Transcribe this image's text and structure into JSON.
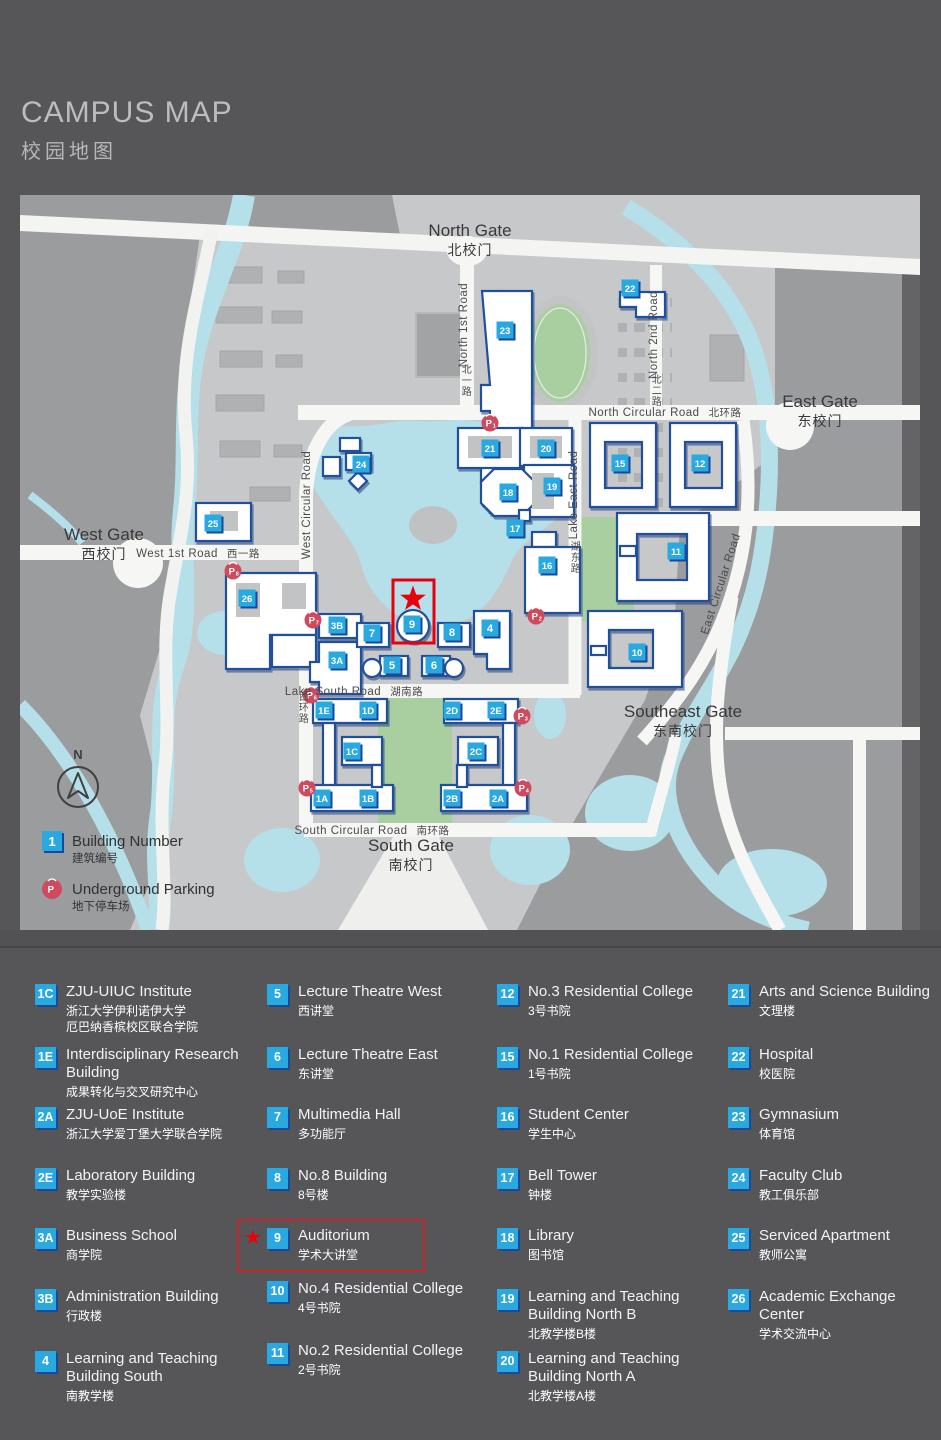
{
  "title": {
    "en": "CAMPUS MAP",
    "zh": "校园地图"
  },
  "colors": {
    "accent_blue": "#29a9e0",
    "badge_shadow": "#194b9d",
    "building_outline": "#24509b",
    "highlight_red": "#e8000d",
    "legend_box_red": "#c2262e",
    "parking_red": "#ce4a5e",
    "water": "#b5dfe9",
    "green": "#a9cfa0",
    "map_bg": "#c7c8c9",
    "outside_gray": "#9b9c9e"
  },
  "map": {
    "gates": [
      {
        "id": "north-gate",
        "en": "North Gate",
        "zh": "北校门",
        "x": 450,
        "y": 41
      },
      {
        "id": "east-gate",
        "en": "East Gate",
        "zh": "东校门",
        "x": 800,
        "y": 212
      },
      {
        "id": "west-gate",
        "en": "West Gate",
        "zh": "西校门",
        "x": 84,
        "y": 345
      },
      {
        "id": "southeast-gate",
        "en": "Southeast Gate",
        "zh": "东南校门",
        "x": 663,
        "y": 522
      },
      {
        "id": "south-gate",
        "en": "South Gate",
        "zh": "南校门",
        "x": 391,
        "y": 656
      }
    ],
    "road_labels": [
      {
        "id": "north-circular-road",
        "en": "North Circular Road",
        "zh": "北环路",
        "x": 645,
        "y": 221,
        "rot": 0
      },
      {
        "id": "north-1st-road",
        "en": "North 1st Road",
        "x": 447,
        "y": 130,
        "rot": -90
      },
      {
        "id": "north-1st-road-zh",
        "zh": "北一路",
        "x": 447,
        "y": 178,
        "stack": true
      },
      {
        "id": "north-2nd-road",
        "en": "North 2nd Road",
        "x": 637,
        "y": 140,
        "rot": -90
      },
      {
        "id": "north-2nd-road-zh",
        "zh": "北二路",
        "x": 637,
        "y": 188,
        "stack": true
      },
      {
        "id": "west-circular-road",
        "en": "West Circular Road",
        "x": 290,
        "y": 310,
        "rot": -90
      },
      {
        "id": "west-circular-road-zh",
        "zh": "西环路",
        "x": 284,
        "y": 505,
        "stack": true
      },
      {
        "id": "west-1st-road",
        "en": "West 1st Road",
        "zh": "西一路",
        "x": 178,
        "y": 362,
        "rot": 0
      },
      {
        "id": "lake-east-road",
        "en": "Lake East Road",
        "x": 557,
        "y": 300,
        "rot": -90
      },
      {
        "id": "lake-east-road-zh",
        "zh": "湖东路",
        "x": 556,
        "y": 355,
        "stack": true
      },
      {
        "id": "lake-south-road",
        "en": "Lake South Road",
        "zh": "湖南路",
        "x": 334,
        "y": 500,
        "rot": 0
      },
      {
        "id": "east-circular-road",
        "en": "East Circular Road",
        "x": 704,
        "y": 390,
        "rot": -72
      },
      {
        "id": "south-circular-road",
        "en": "South Circular Road",
        "zh": "南环路",
        "x": 352,
        "y": 639,
        "rot": 0
      }
    ],
    "building_badges": [
      {
        "id": "23",
        "x": 485,
        "y": 135
      },
      {
        "id": "22",
        "x": 610,
        "y": 93
      },
      {
        "id": "21",
        "x": 470,
        "y": 253
      },
      {
        "id": "20",
        "x": 526,
        "y": 253
      },
      {
        "id": "15",
        "x": 600,
        "y": 268
      },
      {
        "id": "12",
        "x": 680,
        "y": 268
      },
      {
        "id": "18",
        "x": 488,
        "y": 297
      },
      {
        "id": "19",
        "x": 532,
        "y": 291
      },
      {
        "id": "17",
        "x": 495,
        "y": 333
      },
      {
        "id": "16",
        "x": 527,
        "y": 370
      },
      {
        "id": "11",
        "x": 656,
        "y": 356
      },
      {
        "id": "10",
        "x": 617,
        "y": 457
      },
      {
        "id": "25",
        "x": 193,
        "y": 328
      },
      {
        "id": "24",
        "x": 341,
        "y": 269
      },
      {
        "id": "26",
        "x": 227,
        "y": 403
      },
      {
        "id": "3B",
        "x": 317,
        "y": 430
      },
      {
        "id": "7",
        "x": 352,
        "y": 438
      },
      {
        "id": "9",
        "x": 392,
        "y": 429
      },
      {
        "id": "8",
        "x": 432,
        "y": 437
      },
      {
        "id": "4",
        "x": 470,
        "y": 433
      },
      {
        "id": "3A",
        "x": 317,
        "y": 465
      },
      {
        "id": "5",
        "x": 372,
        "y": 470
      },
      {
        "id": "6",
        "x": 414,
        "y": 470
      },
      {
        "id": "1E",
        "x": 304,
        "y": 515
      },
      {
        "id": "1D",
        "x": 348,
        "y": 515
      },
      {
        "id": "2D",
        "x": 432,
        "y": 515
      },
      {
        "id": "2E",
        "x": 476,
        "y": 515
      },
      {
        "id": "1C",
        "x": 332,
        "y": 556
      },
      {
        "id": "2C",
        "x": 456,
        "y": 556
      },
      {
        "id": "1A",
        "x": 302,
        "y": 603
      },
      {
        "id": "1B",
        "x": 348,
        "y": 603
      },
      {
        "id": "2B",
        "x": 432,
        "y": 603
      },
      {
        "id": "2A",
        "x": 478,
        "y": 603
      }
    ],
    "parking": [
      {
        "n": "1",
        "x": 470,
        "y": 228
      },
      {
        "n": "2",
        "x": 516,
        "y": 421
      },
      {
        "n": "3",
        "x": 502,
        "y": 521
      },
      {
        "n": "4",
        "x": 503,
        "y": 593
      },
      {
        "n": "5",
        "x": 287,
        "y": 593
      },
      {
        "n": "6",
        "x": 291,
        "y": 500
      },
      {
        "n": "7",
        "x": 293,
        "y": 425
      },
      {
        "n": "8",
        "x": 213,
        "y": 376
      }
    ],
    "highlight": {
      "building": "9",
      "box": {
        "x": 373,
        "y": 385,
        "w": 41,
        "h": 63
      },
      "star": {
        "x": 393,
        "y": 404
      }
    },
    "compass": {
      "label": "N",
      "x": 58,
      "y": 592
    },
    "map_key": {
      "building_number": {
        "badge": "1",
        "en": "Building Number",
        "zh": "建筑编号"
      },
      "underground_parking": {
        "en": "Underground Parking",
        "zh": "地下停车场"
      }
    }
  },
  "legend": {
    "columns": [
      [
        {
          "id": "1C",
          "en": "ZJU-UIUC Institute",
          "zh": "浙江大学伊利诺伊大学\n厄巴纳香槟校区联合学院"
        },
        {
          "id": "1E",
          "en": "Interdisciplinary Research Building",
          "zh": "成果转化与交叉研究中心"
        },
        {
          "id": "2A",
          "en": "ZJU-UoE Institute",
          "zh": "浙江大学爱丁堡大学联合学院"
        },
        {
          "id": "2E",
          "en": "Laboratory Building",
          "zh": "教学实验楼"
        },
        {
          "id": "3A",
          "en": "Business School",
          "zh": "商学院"
        },
        {
          "id": "3B",
          "en": "Administration Building",
          "zh": "行政楼"
        },
        {
          "id": "4",
          "en": "Learning and Teaching Building South",
          "zh": "南教学楼"
        }
      ],
      [
        {
          "id": "5",
          "en": "Lecture Theatre West",
          "zh": "西讲堂"
        },
        {
          "id": "6",
          "en": "Lecture Theatre East",
          "zh": "东讲堂"
        },
        {
          "id": "7",
          "en": "Multimedia Hall",
          "zh": "多功能厅"
        },
        {
          "id": "8",
          "en": "No.8 Building",
          "zh": "8号楼"
        },
        {
          "id": "9",
          "en": "Auditorium",
          "zh": "学术大讲堂",
          "highlight": true
        },
        {
          "id": "10",
          "en": "No.4 Residential College",
          "zh": "4号书院"
        },
        {
          "id": "11",
          "en": "No.2 Residential College",
          "zh": "2号书院"
        }
      ],
      [
        {
          "id": "12",
          "en": "No.3 Residential College",
          "zh": "3号书院"
        },
        {
          "id": "15",
          "en": "No.1 Residential College",
          "zh": "1号书院"
        },
        {
          "id": "16",
          "en": "Student Center",
          "zh": "学生中心"
        },
        {
          "id": "17",
          "en": "Bell Tower",
          "zh": "钟楼"
        },
        {
          "id": "18",
          "en": "Library",
          "zh": "图书馆"
        },
        {
          "id": "19",
          "en": "Learning and Teaching Building North B",
          "zh": "北教学楼B楼"
        },
        {
          "id": "20",
          "en": "Learning and Teaching Building North A",
          "zh": "北教学楼A楼"
        }
      ],
      [
        {
          "id": "21",
          "en": "Arts and Science Building",
          "zh": "文理楼"
        },
        {
          "id": "22",
          "en": "Hospital",
          "zh": "校医院"
        },
        {
          "id": "23",
          "en": "Gymnasium",
          "zh": "体育馆"
        },
        {
          "id": "24",
          "en": "Faculty Club",
          "zh": "教工俱乐部"
        },
        {
          "id": "25",
          "en": "Serviced Apartment",
          "zh": "教师公寓"
        },
        {
          "id": "26",
          "en": "Academic Exchange Center",
          "zh": "学术交流中心"
        }
      ]
    ]
  }
}
